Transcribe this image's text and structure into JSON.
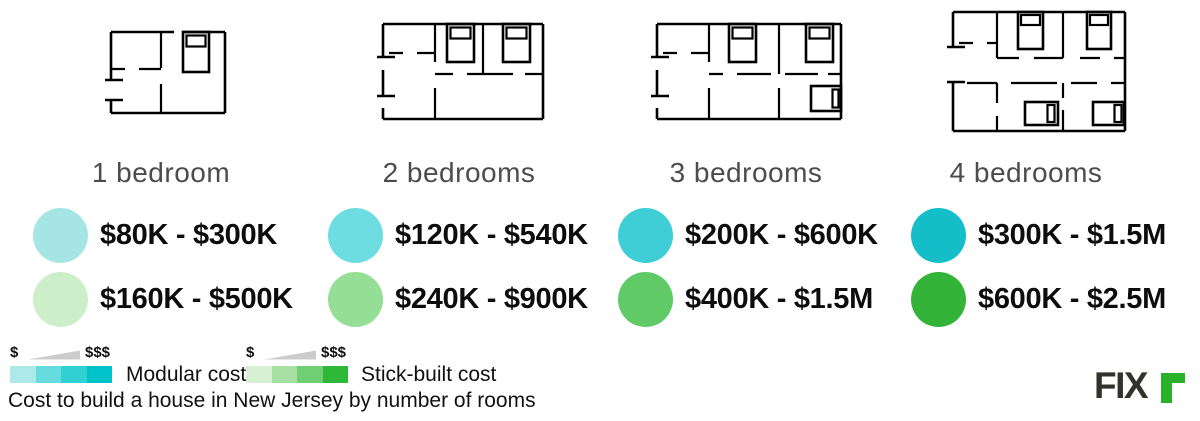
{
  "caption": "Cost to build a house in New Jersey by number of rooms",
  "columns": [
    {
      "label": "1 bedroom",
      "floorplan_icon": "floorplan-1-bedroom",
      "modular_range": "$80K - $300K",
      "modular_color": "#a5e6e4",
      "stick_range": "$160K - $500K",
      "stick_color": "#cceec9"
    },
    {
      "label": "2 bedrooms",
      "floorplan_icon": "floorplan-2-bedrooms",
      "modular_range": "$120K - $540K",
      "modular_color": "#6edde1",
      "stick_range": "$240K - $900K",
      "stick_color": "#95de95"
    },
    {
      "label": "3 bedrooms",
      "floorplan_icon": "floorplan-3-bedrooms",
      "modular_range": "$200K - $600K",
      "modular_color": "#3fcdd6",
      "stick_range": "$400K - $1.5M",
      "stick_color": "#5fca66"
    },
    {
      "label": "4 bedrooms",
      "floorplan_icon": "floorplan-4-bedrooms",
      "modular_range": "$300K - $1.5M",
      "modular_color": "#14bec9",
      "stick_range": "$600K - $2.5M",
      "stick_color": "#33b438"
    }
  ],
  "legend": {
    "modular": {
      "label": "Modular cost",
      "low": "$",
      "high": "$$$",
      "colors": [
        "#ace9e8",
        "#67dcdd",
        "#30d0d3",
        "#00c3c9"
      ]
    },
    "stick_built": {
      "label": "Stick-built cost",
      "low": "$",
      "high": "$$$",
      "colors": [
        "#d7f0d4",
        "#a6e1a3",
        "#6fcf72",
        "#2eb837"
      ]
    },
    "wedge_color": "#cccccc"
  },
  "logo": {
    "dark_text": "FIX",
    "green_letter": "r",
    "dark_color": "#32322c",
    "green_color": "#29b229"
  },
  "chart_data": {
    "type": "table",
    "title": "Cost to build a house in New Jersey by number of rooms",
    "categories": [
      "1 bedroom",
      "2 bedrooms",
      "3 bedrooms",
      "4 bedrooms"
    ],
    "series": [
      {
        "name": "Modular cost",
        "ranges": [
          "$80K - $300K",
          "$120K - $540K",
          "$200K - $600K",
          "$300K - $1.5M"
        ],
        "min_usd": [
          80000,
          120000,
          200000,
          300000
        ],
        "max_usd": [
          300000,
          540000,
          600000,
          1500000
        ]
      },
      {
        "name": "Stick-built cost",
        "ranges": [
          "$160K - $500K",
          "$240K - $900K",
          "$400K - $1.5M",
          "$600K - $2.5M"
        ],
        "min_usd": [
          160000,
          240000,
          400000,
          600000
        ],
        "max_usd": [
          500000,
          900000,
          1500000,
          2500000
        ]
      }
    ],
    "legend_position": "bottom-left"
  }
}
